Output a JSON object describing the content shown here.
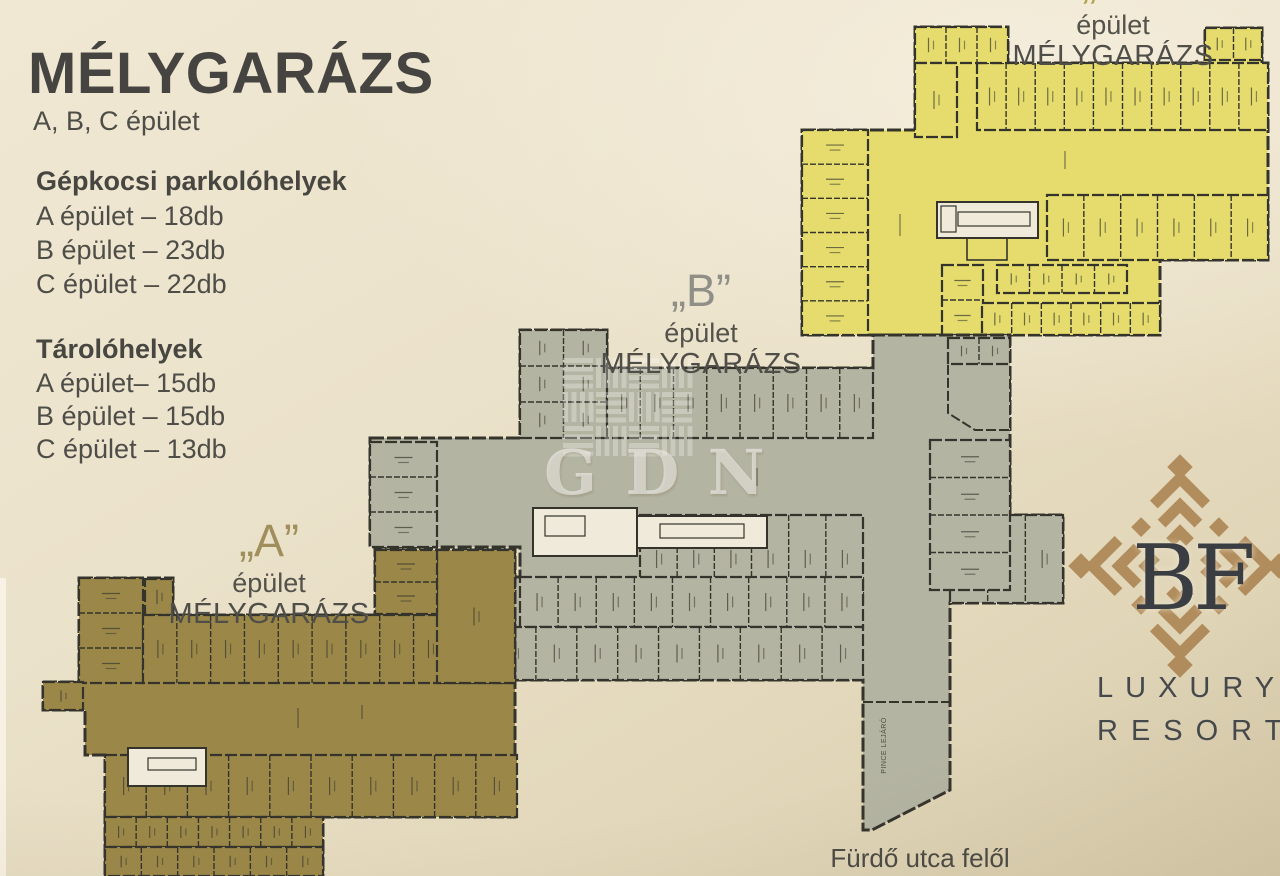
{
  "info_panel": {
    "title": "MÉLYGARÁZS",
    "subtitle": "A, B, C épület",
    "parking": {
      "heading": "Gépkocsi parkolóhelyek",
      "items": [
        "A épület – 18db",
        "B épület – 23db",
        "C épület – 22db"
      ]
    },
    "storage": {
      "heading": "Tárolóhelyek",
      "items": [
        "A épület– 15db",
        "B épület – 15db",
        "C épület – 13db"
      ]
    }
  },
  "plan_labels": {
    "a": {
      "letter": "„A”",
      "building": "épület",
      "type": "MÉLYGARÁZS"
    },
    "b": {
      "letter": "„B”",
      "building": "épület",
      "type": "MÉLYGARÁZS"
    },
    "c": {
      "letter": "„C”",
      "building": "épület",
      "type": "MÉLYGARÁZS"
    }
  },
  "annotations": {
    "street": "Fürdő utca felől",
    "ramp": "PINCE LEJÁRÓ"
  },
  "watermark": {
    "text": "GDN"
  },
  "logo": {
    "initials": "BF",
    "word1": "LUXURY",
    "word2": "RESORT"
  },
  "colors": {
    "building_a": "#9b8849",
    "building_b": "#b4b4a3",
    "building_c": "#e5dc6d",
    "walls": "#35342c",
    "paper": "#ebe2cb",
    "logo_gold": "#b18c5c",
    "label_a": "#a08f5d",
    "label_b": "#8f8f88",
    "label_c": "#b1a44e",
    "white_room": "#efead9"
  }
}
